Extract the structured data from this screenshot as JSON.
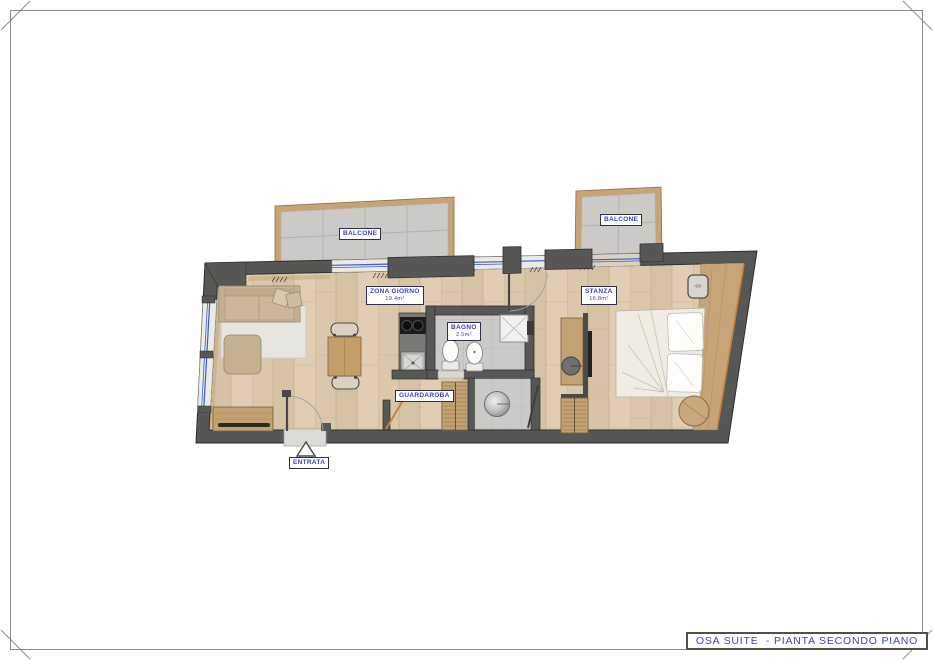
{
  "sheet": {
    "title_block": "OSA SUITE  - PIANTA SECONDO PIANO"
  },
  "rooms": {
    "balcone_left": {
      "label": "BALCONE"
    },
    "balcone_right": {
      "label": "BALCONE"
    },
    "zona_giorno": {
      "label": "ZONA GIORNO",
      "area": "19.4m²"
    },
    "stanza": {
      "label": "STANZA",
      "area": "16.8m²"
    },
    "bagno": {
      "label": "BAGNO",
      "area": "2.5m²"
    },
    "guardaroba": {
      "label": "GUARDAROBA"
    },
    "entrata": {
      "label": "ENTRATA"
    }
  },
  "colors": {
    "wall": "#575756",
    "wood_floor": "#dbc8ac",
    "tile_floor": "#cbcac6",
    "furniture_wood": "#c2a173",
    "window_glazing": "#3b5bd7",
    "door_accent": "#c8803d",
    "label_text": "#3c3ccc"
  }
}
